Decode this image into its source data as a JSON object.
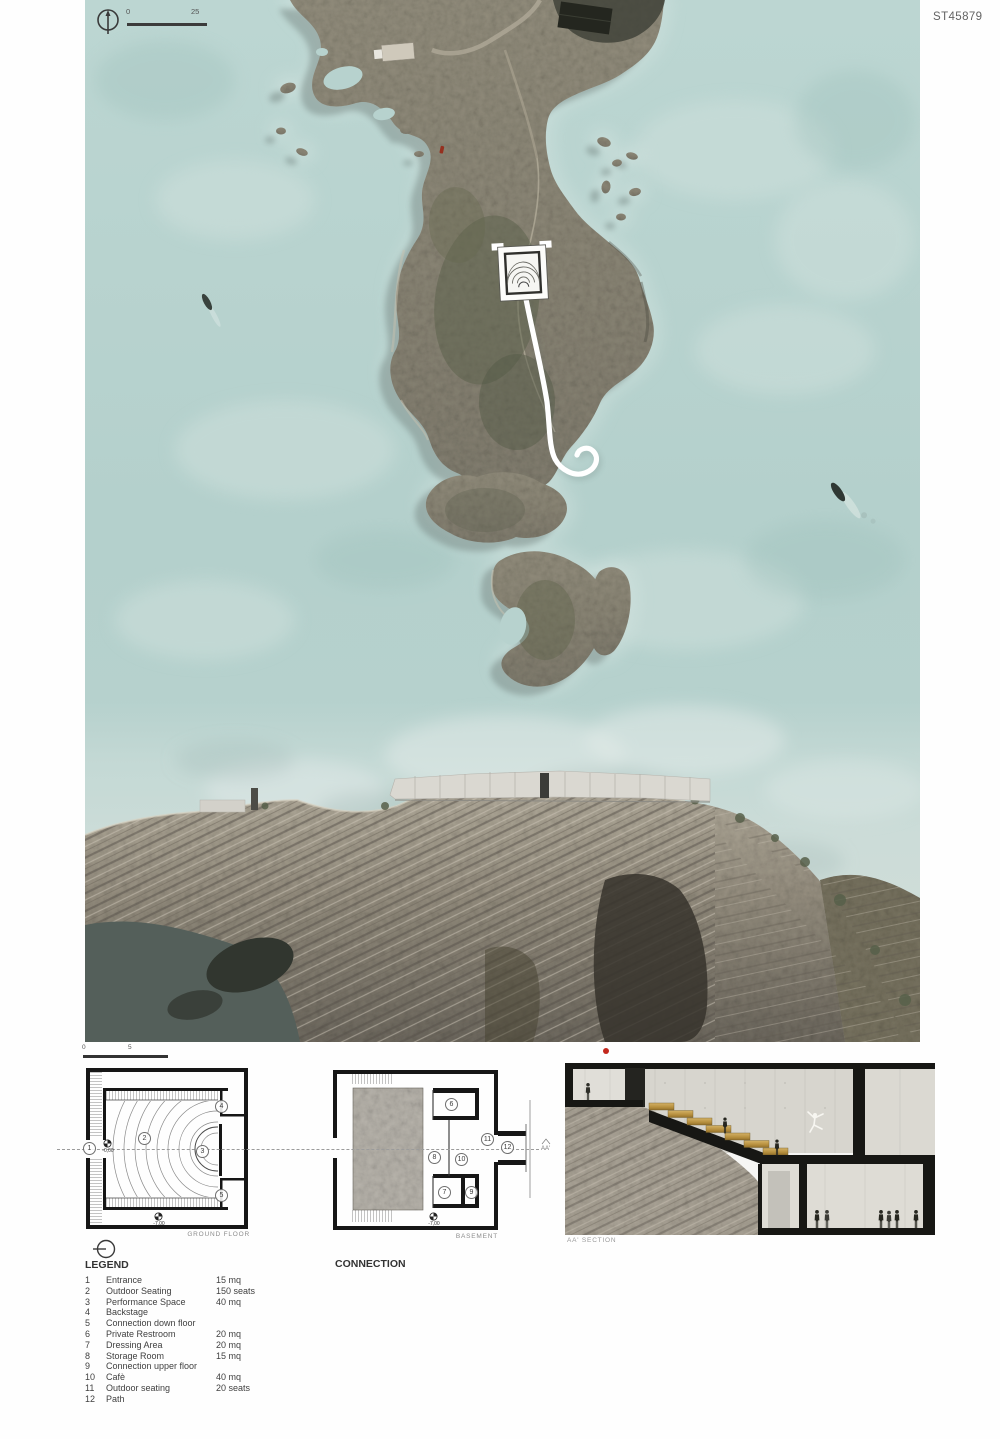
{
  "board": {
    "code": "ST45879"
  },
  "map": {
    "scale": {
      "start": "0",
      "end": "25"
    }
  },
  "drawings": {
    "ground": {
      "label": "GROUND FLOOR",
      "scale_start": "0",
      "scale_end": "5",
      "level_top": "-0,00",
      "level_bottom": "-7,00",
      "rooms": [
        "1",
        "2",
        "3",
        "4",
        "5"
      ]
    },
    "basement": {
      "label": "BASEMENT",
      "level": "-7,00",
      "section_mark": "AA'",
      "rooms": [
        "6",
        "7",
        "8",
        "9",
        "10",
        "11",
        "12"
      ]
    },
    "section": {
      "label": "AA' SECTION"
    }
  },
  "legend": {
    "title": "LEGEND",
    "items": [
      {
        "num": "1",
        "name": "Entrance",
        "value": "15 mq"
      },
      {
        "num": "2",
        "name": "Outdoor Seating",
        "value": "150 seats"
      },
      {
        "num": "3",
        "name": "Performance Space",
        "value": "40 mq"
      },
      {
        "num": "4",
        "name": "Backstage",
        "value": ""
      },
      {
        "num": "5",
        "name": "Connection down floor",
        "value": ""
      },
      {
        "num": "6",
        "name": "Private Restroom",
        "value": "20 mq"
      },
      {
        "num": "7",
        "name": "Dressing Area",
        "value": "20 mq"
      },
      {
        "num": "8",
        "name": "Storage Room",
        "value": "15 mq"
      },
      {
        "num": "9",
        "name": "Connection upper floor",
        "value": ""
      },
      {
        "num": "10",
        "name": "Cafè",
        "value": "40 mq"
      },
      {
        "num": "11",
        "name": "Outdoor seating",
        "value": "20 seats"
      },
      {
        "num": "12",
        "name": "Path",
        "value": ""
      }
    ]
  },
  "connection": {
    "title": "CONNECTION",
    "paragraphs": [
      "The site, a land tongue advancing on the sea, jagged and wild, where you can read the signs of an ancient fortified architecture.",
      "A place where sea, stones and sky join, where the same geometry as the ruined settlement becomes a single body of nature itself.",
      "A building in such a context may compromise irredeemably the caretaker, the authenticity of the site, and on the other hand, it may fail to start an effective process of enjoying and understanding the place.",
      "The project of an open theater, with various annexed services, is transformed into the idea of a path, which suggests and accompanies the site visit. Through semi-prague architecture, it has entered the depths of the rock to reach face to face with the majesty of the ocean and its winds, driven by a light beam coming from above.",
      "A project that becomes complete with the union of pure geometric shapes, where a theater is formed inside a square, with a semi-spherical stage and the steps are generated as waves, in repetition; then arriving at the semicircular panoramic point, on the extreme north of the earth's tongue.",
      "An icon shape, in synthesis with the place and its history. Reinforced concrete walls are solid as a fortress and the interior details derived from the materials found in the context.",
      "In the harmony of geometries, the contemplation and the transcendence of being are inserted."
    ]
  },
  "colors": {
    "sea": "#b7d2ce",
    "accent_red": "#c3271c"
  }
}
